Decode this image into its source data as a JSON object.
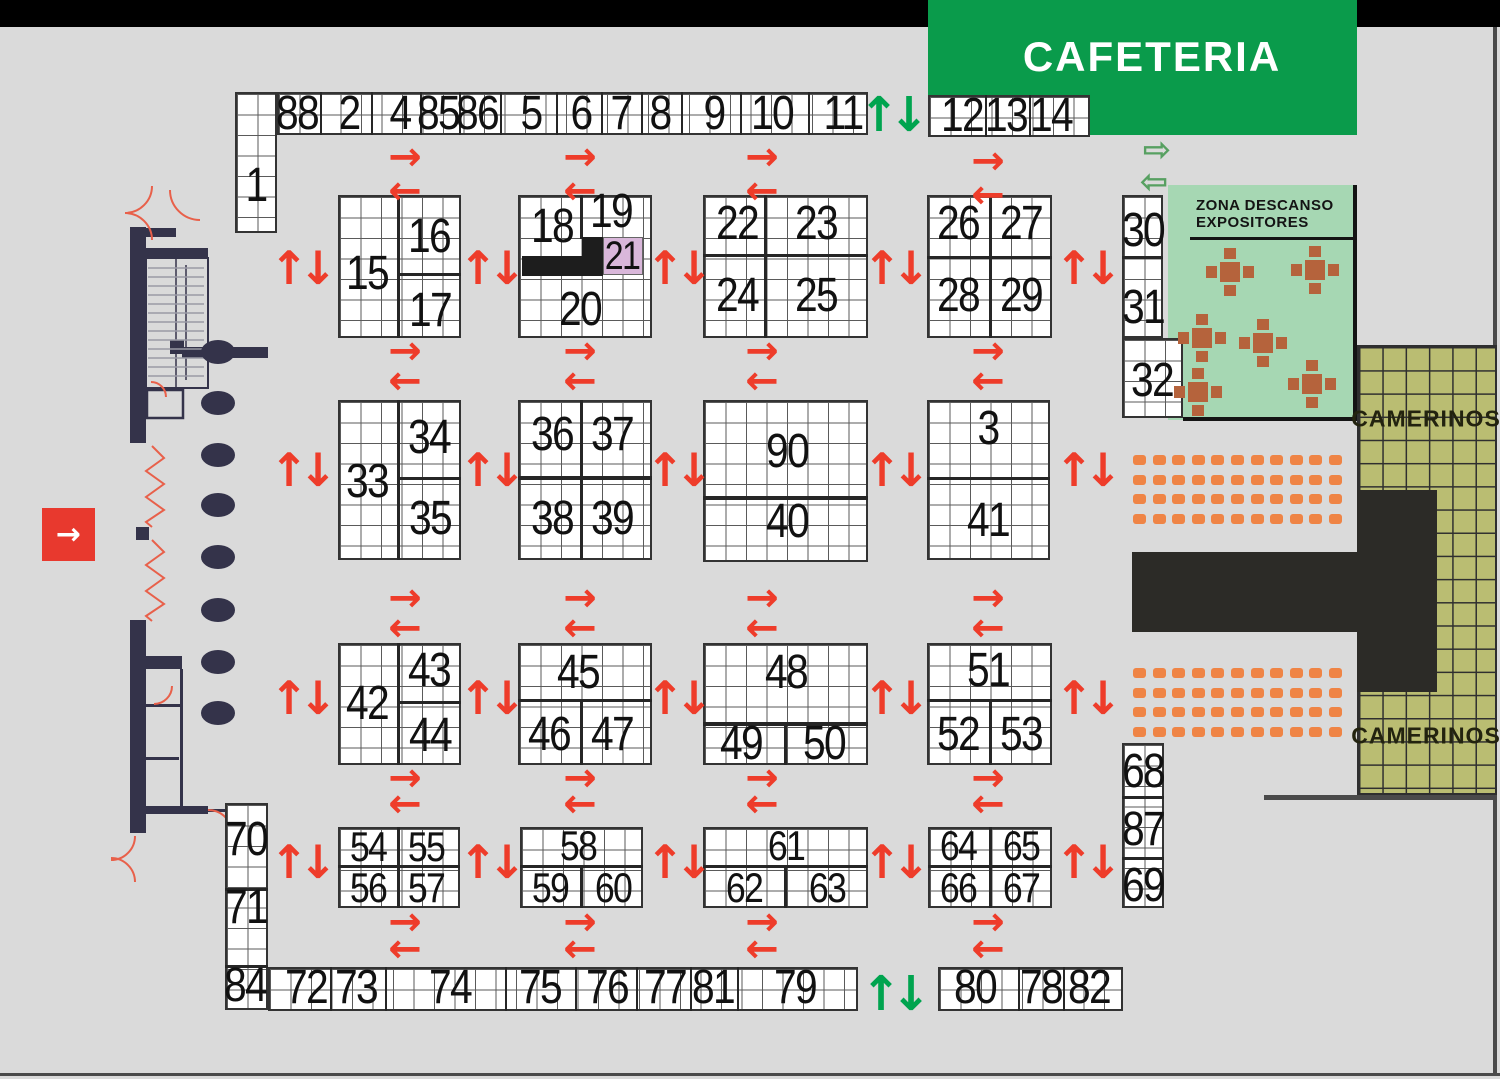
{
  "cafeteria": {
    "label": "CAFETERIA"
  },
  "rest_zone": {
    "line1": "ZONA DESCANSO",
    "line2": "EXPOSITORES"
  },
  "camerinos": {
    "label": "CAMERINOS"
  },
  "entrance": {
    "icon": "→"
  },
  "colors": {
    "cafeteria_green": "#0a9b4b",
    "rest_zone_green": "#a6d7b3",
    "camerinos_khaki": "#babd72",
    "stage_black": "#2c2b27",
    "seat_orange": "#ef8445",
    "wall_navy": "#34334a",
    "arrow_red": "#ee3c2a",
    "arrow_green": "#00a44f",
    "highlight_purple": "#d9b7da",
    "table_brown": "#b5633c",
    "floor_gray": "#dadada"
  },
  "grids": [
    [
      235,
      92,
      42,
      141
    ],
    [
      277,
      92,
      591,
      43
    ],
    [
      928,
      95,
      162,
      42
    ],
    [
      338,
      195,
      123,
      143
    ],
    [
      518,
      195,
      134,
      143
    ],
    [
      703,
      195,
      165,
      143
    ],
    [
      927,
      195,
      125,
      143
    ],
    [
      1122,
      195,
      41,
      143
    ],
    [
      1122,
      338,
      61,
      80
    ],
    [
      338,
      400,
      123,
      160
    ],
    [
      518,
      400,
      134,
      160
    ],
    [
      703,
      400,
      165,
      162
    ],
    [
      927,
      400,
      123,
      160
    ],
    [
      338,
      643,
      123,
      122
    ],
    [
      518,
      643,
      134,
      122
    ],
    [
      703,
      643,
      165,
      122
    ],
    [
      927,
      643,
      125,
      122
    ],
    [
      225,
      803,
      43,
      207
    ],
    [
      338,
      827,
      122,
      81
    ],
    [
      520,
      827,
      123,
      81
    ],
    [
      703,
      827,
      165,
      81
    ],
    [
      928,
      827,
      124,
      81
    ],
    [
      1122,
      743,
      42,
      165
    ],
    [
      268,
      967,
      590,
      44
    ],
    [
      938,
      967,
      185,
      44
    ]
  ],
  "dividers": [
    [
      397,
      195,
      3,
      143
    ],
    [
      397,
      273,
      64,
      3
    ],
    [
      580,
      195,
      3,
      44
    ],
    [
      764,
      195,
      3,
      143
    ],
    [
      703,
      254,
      165,
      3
    ],
    [
      989,
      195,
      3,
      143
    ],
    [
      927,
      256,
      125,
      3
    ],
    [
      1122,
      256,
      41,
      3
    ],
    [
      397,
      400,
      3,
      160
    ],
    [
      397,
      477,
      64,
      3
    ],
    [
      580,
      400,
      3,
      160
    ],
    [
      518,
      476,
      134,
      4
    ],
    [
      703,
      496,
      165,
      4
    ],
    [
      927,
      477,
      123,
      3
    ],
    [
      397,
      643,
      3,
      122
    ],
    [
      397,
      701,
      64,
      3
    ],
    [
      518,
      699,
      134,
      3
    ],
    [
      580,
      699,
      3,
      66
    ],
    [
      703,
      722,
      165,
      4
    ],
    [
      784,
      722,
      3,
      43
    ],
    [
      927,
      699,
      125,
      3
    ],
    [
      989,
      699,
      3,
      66
    ],
    [
      397,
      827,
      3,
      81
    ],
    [
      338,
      865,
      122,
      3
    ],
    [
      520,
      865,
      123,
      3
    ],
    [
      580,
      865,
      3,
      43
    ],
    [
      703,
      865,
      165,
      3
    ],
    [
      784,
      865,
      3,
      43
    ],
    [
      989,
      827,
      3,
      81
    ],
    [
      928,
      865,
      124,
      3
    ],
    [
      225,
      888,
      43,
      3
    ],
    [
      225,
      965,
      43,
      3
    ],
    [
      1122,
      796,
      42,
      3
    ],
    [
      1122,
      857,
      42,
      3
    ],
    [
      320,
      92,
      2,
      43
    ],
    [
      371,
      92,
      2,
      43
    ],
    [
      420,
      92,
      2,
      43
    ],
    [
      459,
      92,
      2,
      43
    ],
    [
      500,
      92,
      2,
      43
    ],
    [
      556,
      92,
      2,
      43
    ],
    [
      601,
      92,
      2,
      43
    ],
    [
      641,
      92,
      2,
      43
    ],
    [
      681,
      92,
      2,
      43
    ],
    [
      740,
      92,
      2,
      43
    ],
    [
      808,
      92,
      2,
      43
    ],
    [
      985,
      95,
      2,
      42
    ],
    [
      1029,
      95,
      2,
      42
    ],
    [
      330,
      967,
      2,
      44
    ],
    [
      385,
      967,
      2,
      44
    ],
    [
      505,
      967,
      2,
      44
    ],
    [
      575,
      967,
      2,
      44
    ],
    [
      636,
      967,
      2,
      44
    ],
    [
      690,
      967,
      2,
      44
    ],
    [
      737,
      967,
      2,
      44
    ],
    [
      1018,
      967,
      2,
      44
    ],
    [
      1063,
      967,
      2,
      44
    ]
  ],
  "black_cells": [
    [
      522,
      256,
      81,
      20
    ],
    [
      582,
      237,
      21,
      20
    ]
  ],
  "highlight_cell": [
    603,
    237,
    40,
    38
  ],
  "booths": [
    {
      "n": "1",
      "x": 256,
      "y": 186
    },
    {
      "n": "88",
      "x": 297,
      "y": 114
    },
    {
      "n": "2",
      "x": 349,
      "y": 114
    },
    {
      "n": "4",
      "x": 400,
      "y": 114
    },
    {
      "n": "85",
      "x": 438,
      "y": 114
    },
    {
      "n": "86",
      "x": 477,
      "y": 114
    },
    {
      "n": "5",
      "x": 531,
      "y": 114
    },
    {
      "n": "6",
      "x": 581,
      "y": 114
    },
    {
      "n": "7",
      "x": 621,
      "y": 114
    },
    {
      "n": "8",
      "x": 660,
      "y": 114
    },
    {
      "n": "9",
      "x": 714,
      "y": 114
    },
    {
      "n": "10",
      "x": 772,
      "y": 114
    },
    {
      "n": "11",
      "x": 843,
      "y": 114
    },
    {
      "n": "12",
      "x": 962,
      "y": 116
    },
    {
      "n": "13",
      "x": 1006,
      "y": 116
    },
    {
      "n": "14",
      "x": 1051,
      "y": 116
    },
    {
      "n": "15",
      "x": 367,
      "y": 274
    },
    {
      "n": "16",
      "x": 429,
      "y": 237
    },
    {
      "n": "17",
      "x": 430,
      "y": 311
    },
    {
      "n": "18",
      "x": 552,
      "y": 227
    },
    {
      "n": "19",
      "x": 611,
      "y": 212
    },
    {
      "n": "21",
      "x": 622,
      "y": 256,
      "fs": 40
    },
    {
      "n": "20",
      "x": 580,
      "y": 310
    },
    {
      "n": "22",
      "x": 737,
      "y": 224
    },
    {
      "n": "23",
      "x": 816,
      "y": 224
    },
    {
      "n": "24",
      "x": 737,
      "y": 296
    },
    {
      "n": "25",
      "x": 816,
      "y": 296
    },
    {
      "n": "26",
      "x": 958,
      "y": 224
    },
    {
      "n": "27",
      "x": 1021,
      "y": 224
    },
    {
      "n": "28",
      "x": 958,
      "y": 296
    },
    {
      "n": "29",
      "x": 1021,
      "y": 296
    },
    {
      "n": "30",
      "x": 1143,
      "y": 231
    },
    {
      "n": "31",
      "x": 1143,
      "y": 308
    },
    {
      "n": "32",
      "x": 1152,
      "y": 381
    },
    {
      "n": "33",
      "x": 367,
      "y": 482
    },
    {
      "n": "34",
      "x": 429,
      "y": 438
    },
    {
      "n": "35",
      "x": 430,
      "y": 519
    },
    {
      "n": "36",
      "x": 552,
      "y": 435
    },
    {
      "n": "37",
      "x": 612,
      "y": 435
    },
    {
      "n": "38",
      "x": 552,
      "y": 519
    },
    {
      "n": "39",
      "x": 612,
      "y": 519
    },
    {
      "n": "90",
      "x": 787,
      "y": 452
    },
    {
      "n": "40",
      "x": 787,
      "y": 522
    },
    {
      "n": "3",
      "x": 988,
      "y": 429
    },
    {
      "n": "41",
      "x": 988,
      "y": 521
    },
    {
      "n": "42",
      "x": 367,
      "y": 704
    },
    {
      "n": "43",
      "x": 429,
      "y": 671
    },
    {
      "n": "44",
      "x": 430,
      "y": 736
    },
    {
      "n": "45",
      "x": 578,
      "y": 673
    },
    {
      "n": "46",
      "x": 549,
      "y": 735
    },
    {
      "n": "47",
      "x": 612,
      "y": 735
    },
    {
      "n": "48",
      "x": 786,
      "y": 673
    },
    {
      "n": "49",
      "x": 741,
      "y": 744
    },
    {
      "n": "50",
      "x": 824,
      "y": 744
    },
    {
      "n": "51",
      "x": 988,
      "y": 671
    },
    {
      "n": "52",
      "x": 958,
      "y": 735
    },
    {
      "n": "53",
      "x": 1021,
      "y": 735
    },
    {
      "n": "70",
      "x": 246,
      "y": 840
    },
    {
      "n": "71",
      "x": 246,
      "y": 908
    },
    {
      "n": "54",
      "x": 368,
      "y": 847,
      "fs": 42
    },
    {
      "n": "55",
      "x": 426,
      "y": 847,
      "fs": 42
    },
    {
      "n": "56",
      "x": 368,
      "y": 888,
      "fs": 42
    },
    {
      "n": "57",
      "x": 426,
      "y": 888,
      "fs": 42
    },
    {
      "n": "58",
      "x": 578,
      "y": 846,
      "fs": 42
    },
    {
      "n": "59",
      "x": 550,
      "y": 888,
      "fs": 42
    },
    {
      "n": "60",
      "x": 613,
      "y": 888,
      "fs": 42
    },
    {
      "n": "61",
      "x": 786,
      "y": 846,
      "fs": 42
    },
    {
      "n": "62",
      "x": 744,
      "y": 888,
      "fs": 42
    },
    {
      "n": "63",
      "x": 827,
      "y": 888,
      "fs": 42
    },
    {
      "n": "64",
      "x": 958,
      "y": 846,
      "fs": 42
    },
    {
      "n": "65",
      "x": 1021,
      "y": 846,
      "fs": 42
    },
    {
      "n": "66",
      "x": 958,
      "y": 888,
      "fs": 42
    },
    {
      "n": "67",
      "x": 1021,
      "y": 888,
      "fs": 42
    },
    {
      "n": "68",
      "x": 1143,
      "y": 772
    },
    {
      "n": "87",
      "x": 1143,
      "y": 830
    },
    {
      "n": "69",
      "x": 1143,
      "y": 886
    },
    {
      "n": "84",
      "x": 245,
      "y": 986
    },
    {
      "n": "72",
      "x": 306,
      "y": 988
    },
    {
      "n": "73",
      "x": 356,
      "y": 988
    },
    {
      "n": "74",
      "x": 450,
      "y": 988
    },
    {
      "n": "75",
      "x": 540,
      "y": 988
    },
    {
      "n": "76",
      "x": 607,
      "y": 988
    },
    {
      "n": "77",
      "x": 665,
      "y": 988
    },
    {
      "n": "81",
      "x": 713,
      "y": 988
    },
    {
      "n": "79",
      "x": 795,
      "y": 988
    },
    {
      "n": "80",
      "x": 975,
      "y": 988
    },
    {
      "n": "78",
      "x": 1041,
      "y": 988
    },
    {
      "n": "82",
      "x": 1089,
      "y": 988
    }
  ],
  "arrows": {
    "red_right": [
      [
        405,
        157
      ],
      [
        580,
        157
      ],
      [
        762,
        157
      ],
      [
        988,
        161
      ],
      [
        405,
        351
      ],
      [
        580,
        351
      ],
      [
        762,
        351
      ],
      [
        988,
        351
      ],
      [
        405,
        598
      ],
      [
        580,
        598
      ],
      [
        762,
        598
      ],
      [
        988,
        598
      ],
      [
        405,
        778
      ],
      [
        580,
        778
      ],
      [
        762,
        778
      ],
      [
        988,
        778
      ],
      [
        405,
        922
      ],
      [
        580,
        922
      ],
      [
        762,
        922
      ],
      [
        988,
        922
      ]
    ],
    "red_left": [
      [
        405,
        191
      ],
      [
        580,
        191
      ],
      [
        762,
        191
      ],
      [
        988,
        195
      ],
      [
        405,
        381
      ],
      [
        580,
        381
      ],
      [
        762,
        381
      ],
      [
        988,
        381
      ],
      [
        405,
        628
      ],
      [
        580,
        628
      ],
      [
        762,
        628
      ],
      [
        988,
        628
      ],
      [
        405,
        804
      ],
      [
        580,
        804
      ],
      [
        762,
        804
      ],
      [
        988,
        804
      ],
      [
        405,
        949
      ],
      [
        580,
        949
      ],
      [
        762,
        949
      ],
      [
        988,
        949
      ]
    ],
    "red_up": [
      [
        289,
        268
      ],
      [
        478,
        268
      ],
      [
        665,
        268
      ],
      [
        882,
        268
      ],
      [
        1074,
        268
      ],
      [
        289,
        470
      ],
      [
        478,
        470
      ],
      [
        665,
        470
      ],
      [
        882,
        470
      ],
      [
        1074,
        470
      ],
      [
        289,
        698
      ],
      [
        478,
        698
      ],
      [
        665,
        698
      ],
      [
        882,
        698
      ],
      [
        1074,
        698
      ],
      [
        289,
        862
      ],
      [
        478,
        862
      ],
      [
        665,
        862
      ],
      [
        882,
        862
      ],
      [
        1074,
        862
      ]
    ],
    "red_down": [
      [
        318,
        268
      ],
      [
        507,
        268
      ],
      [
        694,
        268
      ],
      [
        911,
        268
      ],
      [
        1103,
        268
      ],
      [
        318,
        470
      ],
      [
        507,
        470
      ],
      [
        694,
        470
      ],
      [
        911,
        470
      ],
      [
        1103,
        470
      ],
      [
        318,
        698
      ],
      [
        507,
        698
      ],
      [
        694,
        698
      ],
      [
        911,
        698
      ],
      [
        1103,
        698
      ],
      [
        318,
        862
      ],
      [
        507,
        862
      ],
      [
        694,
        862
      ],
      [
        911,
        862
      ],
      [
        1103,
        862
      ]
    ],
    "green_up": [
      [
        879,
        115
      ],
      [
        881,
        994
      ]
    ],
    "green_down": [
      [
        909,
        115
      ],
      [
        911,
        994
      ]
    ],
    "pale_right": [
      [
        1157,
        150
      ]
    ],
    "pale_left": [
      [
        1154,
        182
      ]
    ]
  },
  "seat_groups": [
    {
      "x": 1133,
      "y": 455,
      "rows": 4,
      "cols": 11
    },
    {
      "x": 1133,
      "y": 668,
      "rows": 4,
      "cols": 11
    }
  ],
  "tables": [
    [
      1230,
      272
    ],
    [
      1315,
      270
    ],
    [
      1202,
      338
    ],
    [
      1263,
      343
    ],
    [
      1198,
      392
    ],
    [
      1312,
      384
    ]
  ],
  "columns": {
    "x": 218,
    "ys": [
      352,
      403,
      455,
      505,
      557,
      610,
      662,
      713
    ]
  }
}
